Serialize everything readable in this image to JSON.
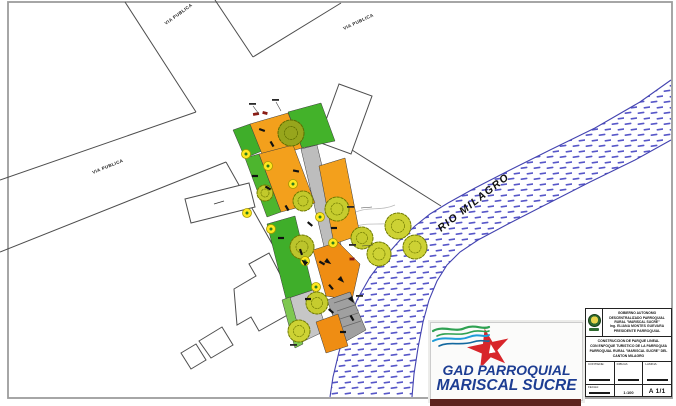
{
  "plan": {
    "streets": {
      "top_label": "VIA PUBLICA",
      "left_label": "VIA PUBLICA",
      "right_label": "VIA PUBLICA"
    },
    "river": {
      "label": "RIO  MILAGRO"
    }
  },
  "title_block": {
    "institution": {
      "line1": "GOBIERNO AUTONOMO",
      "line2": "DESCENTRALIZADO PARROQUIAL",
      "line3": "RURAL \"MARISCAL SUCRE\"",
      "line4": "Ing. ELIANA MONTES GUEVARA",
      "line5": "PRESIDENTE PARROQUIAL"
    },
    "project": {
      "line1": "CONSTRUCCION DE PARQUE LINEAL",
      "line2": "CON ENFOQUE TURISTICO DE LA PARROQUIA",
      "line3": "PARROQUIAL RURAL \"MARISCAL SUCRE\" DEL",
      "line4": "CANTON MILAGRO"
    },
    "fields": {
      "contiene_label": "CONTIENE:",
      "dibuja_label": "DIBUJA:",
      "escala_label": "ESCALA:",
      "fecha_label": "FECHA:",
      "lamina_label": "LAMINA:",
      "escala_value": "1:100",
      "lamina_value": "A 1/1"
    }
  },
  "logo_box": {
    "line1": "GAD PARROQUIAL",
    "line2": "MARISCAL SUCRE"
  },
  "palette": {
    "paper": "#ffffff",
    "linework": "#4d4d4d",
    "frame_gray": "#9c9c9c",
    "river_blue": "#4b4bbd",
    "park_orange": "#f3a01c",
    "park_green": "#3fae2a",
    "path_gray": "#bdbdbd",
    "tree_olive": "#c2c92b",
    "lamp_yellow": "#ffe81f",
    "logo_red": "#d8252a",
    "logo_blue": "#1d3d92",
    "wave_green": "#2fa152",
    "wave_blue": "#1f9cd8",
    "banner_maroon": "#5e231e"
  }
}
